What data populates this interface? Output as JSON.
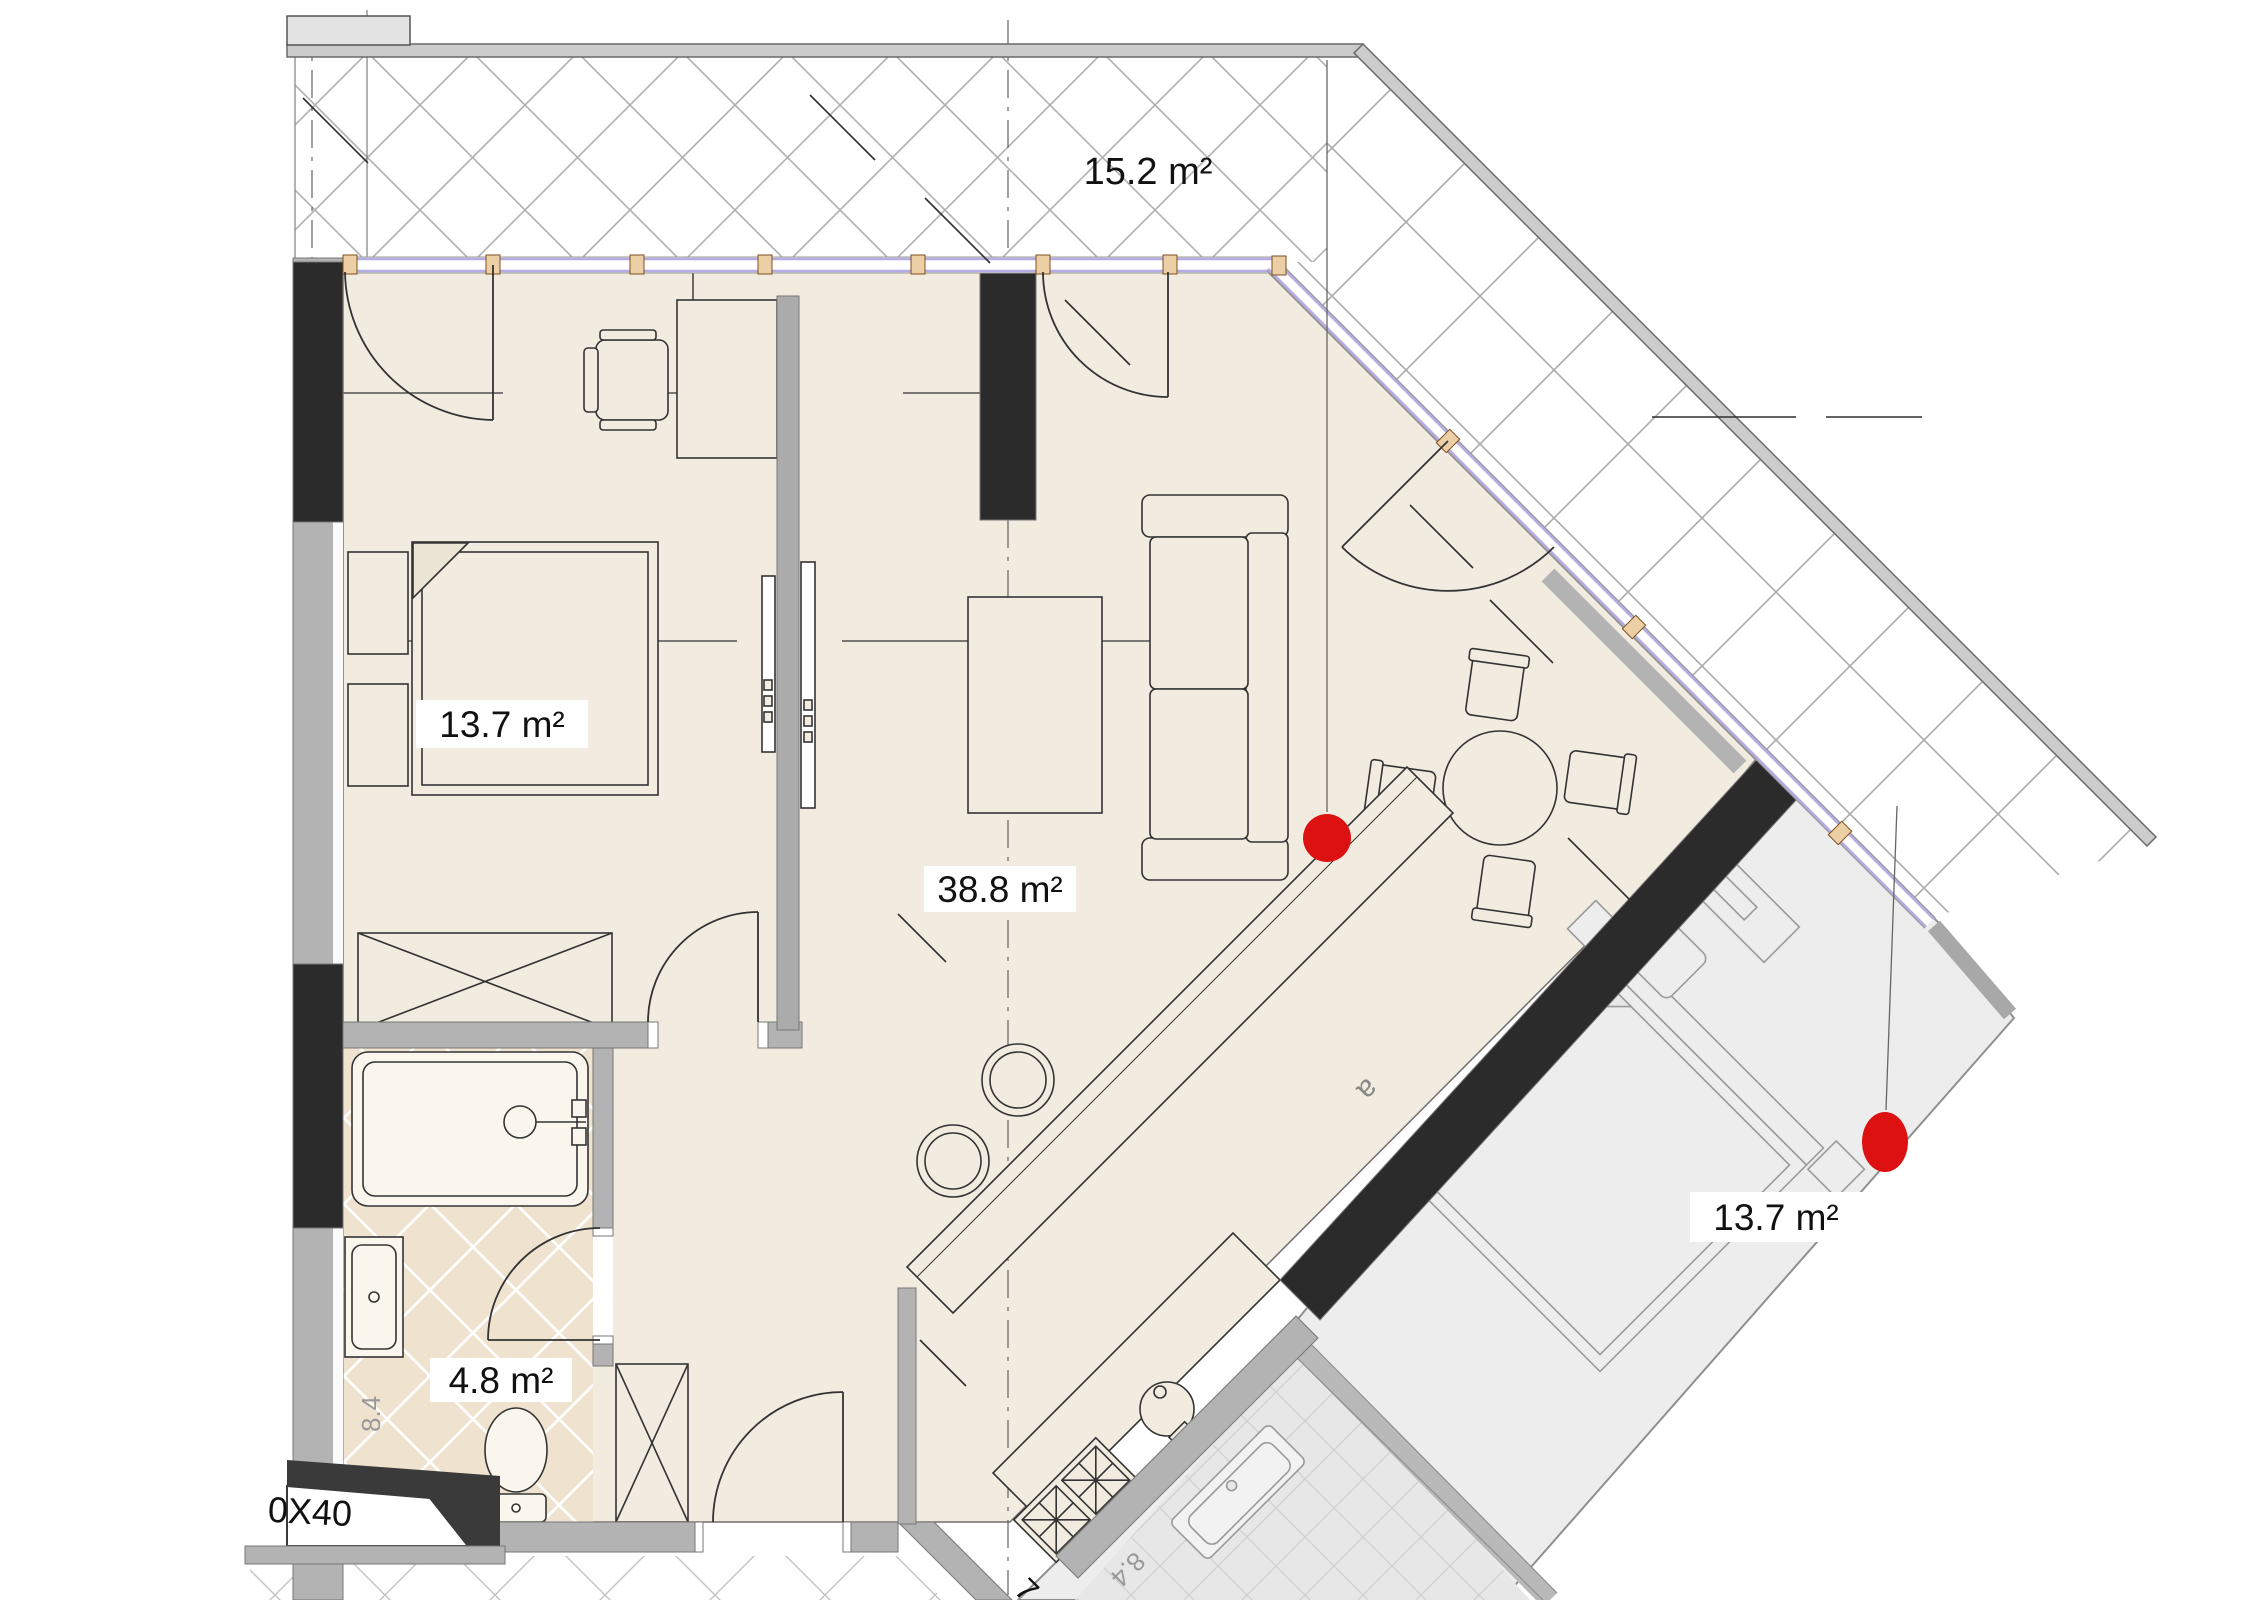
{
  "rooms": {
    "balcony": {
      "label": "15.2 m²"
    },
    "bedroom": {
      "label": "13.7 m²"
    },
    "living": {
      "label": "38.8 m²"
    },
    "bathroom": {
      "label": "4.8 m²"
    },
    "neighbor_bedroom": {
      "label": "13.7 m²"
    }
  },
  "annotations": {
    "shaft_note": "0X40",
    "bath_dim_rotated": "8.4",
    "kitchen_dim_rotated": "8.4",
    "tag_a": "a",
    "dim_clipped": "7"
  },
  "colors": {
    "floor": "#f2ece0",
    "bath_floor": "#efe3cf",
    "wall_gray": "#b3b3b3",
    "wall_black": "#2b2b2b",
    "window_lavender": "#b6abe2",
    "neighbor_fill": "#ededed",
    "hatch": "#b0b0b0",
    "marker_red": "#dd1111"
  }
}
